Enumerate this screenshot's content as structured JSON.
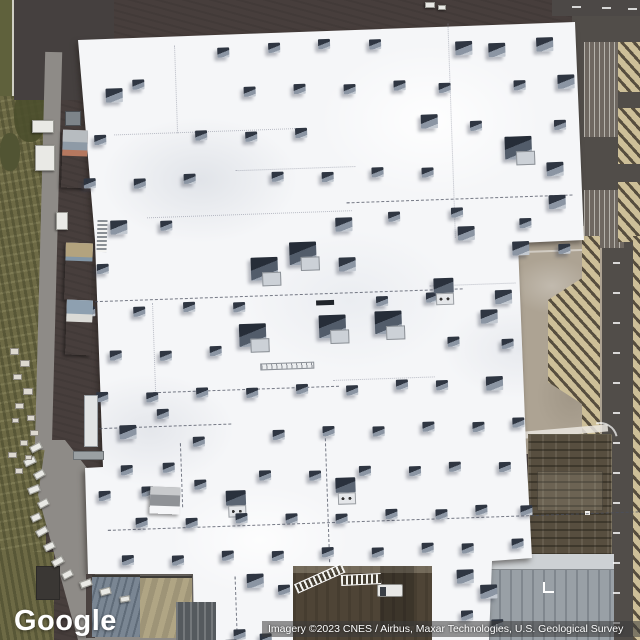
{
  "overlay": {
    "logo_text": "Google",
    "attribution_text": "Imagery ©2023 CNES / Airbus, Maxar Technologies, U.S. Geological Survey"
  },
  "palette": {
    "roof": "#f5f6f8",
    "lot": "#473e3c",
    "grass": "#6d6a45",
    "road": "#8e8b87",
    "apron": "#ada393",
    "right-road": "#514d49",
    "hatch-tan": "#cdbf98",
    "hatch-dark": "#574e3e",
    "courtyard": "#4e4436",
    "unit-dark": "#2f3642",
    "unit-mid": "#8b95a3",
    "unit-light": "#c3c9d1"
  },
  "scene": {
    "units": [
      [
        226,
        44,
        0
      ],
      [
        277,
        41,
        0
      ],
      [
        327,
        39,
        0
      ],
      [
        378,
        41,
        0
      ],
      [
        464,
        46,
        1
      ],
      [
        497,
        49,
        1
      ],
      [
        545,
        45,
        1
      ],
      [
        113,
        81,
        1
      ],
      [
        140,
        73,
        0
      ],
      [
        251,
        84,
        0
      ],
      [
        301,
        83,
        0
      ],
      [
        351,
        85,
        0
      ],
      [
        401,
        83,
        0
      ],
      [
        446,
        87,
        0
      ],
      [
        521,
        87,
        0
      ],
      [
        565,
        83,
        1
      ],
      [
        100,
        127,
        0
      ],
      [
        201,
        126,
        0
      ],
      [
        251,
        129,
        0
      ],
      [
        301,
        127,
        0
      ],
      [
        427,
        118,
        1
      ],
      [
        476,
        126,
        0
      ],
      [
        510,
        143,
        2
      ],
      [
        560,
        128,
        0
      ],
      [
        88,
        170,
        0
      ],
      [
        138,
        172,
        0
      ],
      [
        188,
        169,
        0
      ],
      [
        276,
        170,
        0
      ],
      [
        326,
        172,
        0
      ],
      [
        376,
        169,
        0
      ],
      [
        426,
        171,
        0
      ],
      [
        551,
        170,
        1
      ],
      [
        113,
        213,
        1
      ],
      [
        163,
        215,
        0
      ],
      [
        338,
        218,
        1
      ],
      [
        391,
        214,
        0
      ],
      [
        454,
        212,
        0
      ],
      [
        552,
        203,
        1
      ],
      [
        522,
        225,
        0
      ],
      [
        98,
        256,
        0
      ],
      [
        252,
        255,
        2
      ],
      [
        291,
        241,
        2
      ],
      [
        340,
        258,
        1
      ],
      [
        460,
        231,
        1
      ],
      [
        514,
        248,
        1
      ],
      [
        560,
        252,
        0
      ],
      [
        83,
        298,
        0
      ],
      [
        133,
        300,
        0
      ],
      [
        183,
        297,
        0
      ],
      [
        233,
        299,
        0
      ],
      [
        376,
        298,
        0
      ],
      [
        426,
        296,
        0
      ],
      [
        495,
        296,
        1
      ],
      [
        238,
        321,
        2
      ],
      [
        318,
        315,
        2
      ],
      [
        374,
        313,
        2
      ],
      [
        434,
        282,
        3
      ],
      [
        480,
        315,
        1
      ],
      [
        108,
        343,
        0
      ],
      [
        158,
        345,
        0
      ],
      [
        208,
        342,
        0
      ],
      [
        446,
        341,
        0
      ],
      [
        500,
        345,
        0
      ],
      [
        93,
        384,
        0
      ],
      [
        143,
        386,
        0
      ],
      [
        193,
        383,
        0
      ],
      [
        243,
        385,
        0
      ],
      [
        293,
        383,
        0
      ],
      [
        343,
        386,
        0
      ],
      [
        393,
        382,
        0
      ],
      [
        433,
        384,
        0
      ],
      [
        483,
        382,
        1
      ],
      [
        115,
        418,
        1
      ],
      [
        153,
        403,
        0
      ],
      [
        188,
        432,
        0
      ],
      [
        268,
        428,
        0
      ],
      [
        318,
        426,
        0
      ],
      [
        368,
        428,
        0
      ],
      [
        418,
        425,
        0
      ],
      [
        468,
        427,
        0
      ],
      [
        508,
        424,
        0
      ],
      [
        92,
        483,
        0
      ],
      [
        115,
        458,
        0
      ],
      [
        135,
        480,
        0
      ],
      [
        157,
        457,
        0
      ],
      [
        188,
        475,
        0
      ],
      [
        253,
        468,
        0
      ],
      [
        303,
        470,
        0
      ],
      [
        353,
        467,
        0
      ],
      [
        403,
        469,
        0
      ],
      [
        443,
        466,
        0
      ],
      [
        493,
        468,
        0
      ],
      [
        219,
        487,
        3
      ],
      [
        329,
        478,
        3
      ],
      [
        128,
        511,
        0
      ],
      [
        178,
        513,
        0
      ],
      [
        228,
        510,
        0
      ],
      [
        278,
        512,
        0
      ],
      [
        328,
        514,
        0
      ],
      [
        378,
        511,
        0
      ],
      [
        428,
        513,
        0
      ],
      [
        468,
        510,
        0
      ],
      [
        513,
        512,
        0
      ],
      [
        113,
        548,
        0
      ],
      [
        163,
        550,
        0
      ],
      [
        213,
        547,
        0
      ],
      [
        263,
        549,
        0
      ],
      [
        313,
        547,
        0
      ],
      [
        363,
        549,
        0
      ],
      [
        413,
        546,
        0
      ],
      [
        453,
        548,
        0
      ],
      [
        503,
        545,
        0
      ],
      [
        237,
        571,
        1
      ],
      [
        268,
        583,
        0
      ],
      [
        222,
        626,
        0
      ],
      [
        248,
        631,
        0
      ],
      [
        213,
        636,
        0
      ],
      [
        447,
        574,
        1
      ],
      [
        470,
        590,
        1
      ],
      [
        450,
        615,
        0
      ],
      [
        480,
        625,
        0
      ]
    ],
    "seams_h": [
      [
        120,
        127,
        185,
        0
      ],
      [
        240,
        167,
        120,
        0
      ],
      [
        150,
        211,
        205,
        0
      ],
      [
        350,
        203,
        226,
        1
      ],
      [
        95,
        293,
        368,
        1
      ],
      [
        430,
        289,
        86,
        0
      ],
      [
        150,
        386,
        186,
        1
      ],
      [
        330,
        380,
        102,
        0
      ],
      [
        95,
        420,
        132,
        1
      ],
      [
        100,
        522,
        536,
        1
      ]
    ],
    "seams_v": [
      [
        457,
        28,
        214,
        0
      ],
      [
        183,
        40,
        88,
        0
      ],
      [
        152,
        297,
        94,
        0
      ],
      [
        320,
        428,
        134,
        1
      ],
      [
        175,
        438,
        64,
        1
      ],
      [
        225,
        573,
        60,
        1
      ]
    ],
    "sheds": [
      {
        "x": 62,
        "y": 130,
        "w": 25,
        "h": 58,
        "stripes": [
          [
            "#b5785f",
            45
          ],
          [
            "#8e9aa6",
            35
          ],
          [
            "#b7bcc0",
            20
          ]
        ]
      },
      {
        "x": 65,
        "y": 243,
        "w": 27,
        "h": 57,
        "stripes": [
          [
            "#bd7851",
            30
          ],
          [
            "#d6d2c8",
            14
          ],
          [
            "#8296a6",
            32
          ],
          [
            "#b3a37e",
            24
          ]
        ]
      },
      {
        "x": 66,
        "y": 300,
        "w": 26,
        "h": 55,
        "stripes": [
          [
            "#a2b4c4",
            34
          ],
          [
            "#dadad6",
            40
          ],
          [
            "#8ea0b0",
            26
          ]
        ]
      },
      {
        "x": 150,
        "y": 487,
        "w": 30,
        "h": 27,
        "stripes": [
          [
            "#8f9296",
            70
          ],
          [
            "#c8cacc",
            30
          ]
        ]
      }
    ],
    "trailers": [
      [
        32,
        120,
        22,
        13,
        0
      ],
      [
        35,
        145,
        20,
        26,
        0
      ],
      [
        56,
        212,
        12,
        18,
        0
      ],
      [
        425,
        2,
        10,
        6,
        0
      ],
      [
        438,
        5,
        8,
        5,
        0
      ],
      [
        30,
        444,
        12,
        7,
        -28
      ],
      [
        24,
        458,
        12,
        7,
        -25
      ],
      [
        34,
        471,
        11,
        7,
        -30
      ],
      [
        28,
        486,
        12,
        7,
        -22
      ],
      [
        38,
        500,
        11,
        7,
        -28
      ],
      [
        31,
        514,
        10,
        7,
        -25
      ],
      [
        36,
        528,
        12,
        7,
        -30
      ],
      [
        44,
        543,
        11,
        7,
        -26
      ],
      [
        52,
        558,
        12,
        7,
        -30
      ],
      [
        62,
        571,
        11,
        7,
        -28
      ],
      [
        80,
        580,
        12,
        7,
        -20
      ],
      [
        100,
        588,
        11,
        7,
        -15
      ],
      [
        120,
        596,
        10,
        6,
        -10
      ]
    ],
    "pallets": [
      [
        10,
        348,
        9,
        7
      ],
      [
        20,
        360,
        10,
        7
      ],
      [
        13,
        374,
        9,
        6
      ],
      [
        23,
        388,
        10,
        7
      ],
      [
        15,
        403,
        9,
        6
      ],
      [
        27,
        415,
        8,
        6
      ],
      [
        12,
        418,
        7,
        5
      ],
      [
        30,
        430,
        9,
        6
      ],
      [
        20,
        440,
        8,
        6
      ],
      [
        8,
        452,
        9,
        6
      ],
      [
        25,
        455,
        7,
        5
      ],
      [
        15,
        468,
        8,
        6
      ]
    ],
    "dashes_right": {
      "x": 613,
      "y0": 262,
      "count": 13,
      "gap": 30,
      "w": 7,
      "h": 2
    },
    "dashes_top": [
      [
        572,
        6,
        9,
        2
      ],
      [
        602,
        7,
        9,
        2
      ],
      [
        628,
        8,
        9,
        2
      ]
    ]
  }
}
